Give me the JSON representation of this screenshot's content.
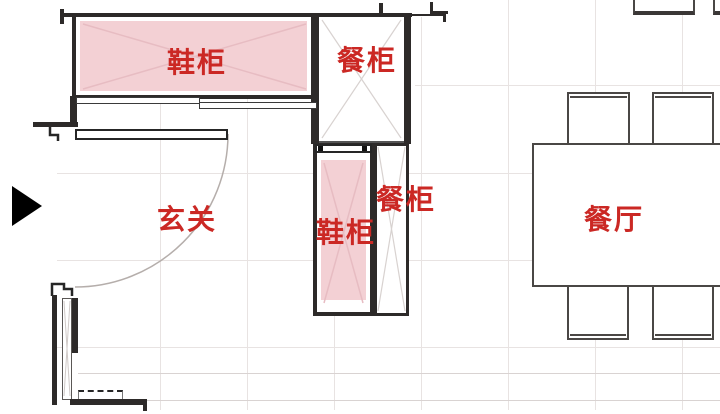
{
  "plan": {
    "labels": {
      "shoe_cabinet_top": "鞋柜",
      "dining_cabinet_top": "餐柜",
      "shoe_cabinet_side": "鞋柜",
      "dining_cabinet_side": "餐柜",
      "entryway": "玄关",
      "dining_room": "餐厅"
    },
    "colors": {
      "label_red": "#cb2824",
      "cabinet_pink_fill": "#f3d0d4",
      "wall_dark": "#2d2a29",
      "grid_line": "#e8e3e2"
    },
    "icons": {
      "entry_arrow": "right-pointing-triangle entrance marker"
    }
  }
}
